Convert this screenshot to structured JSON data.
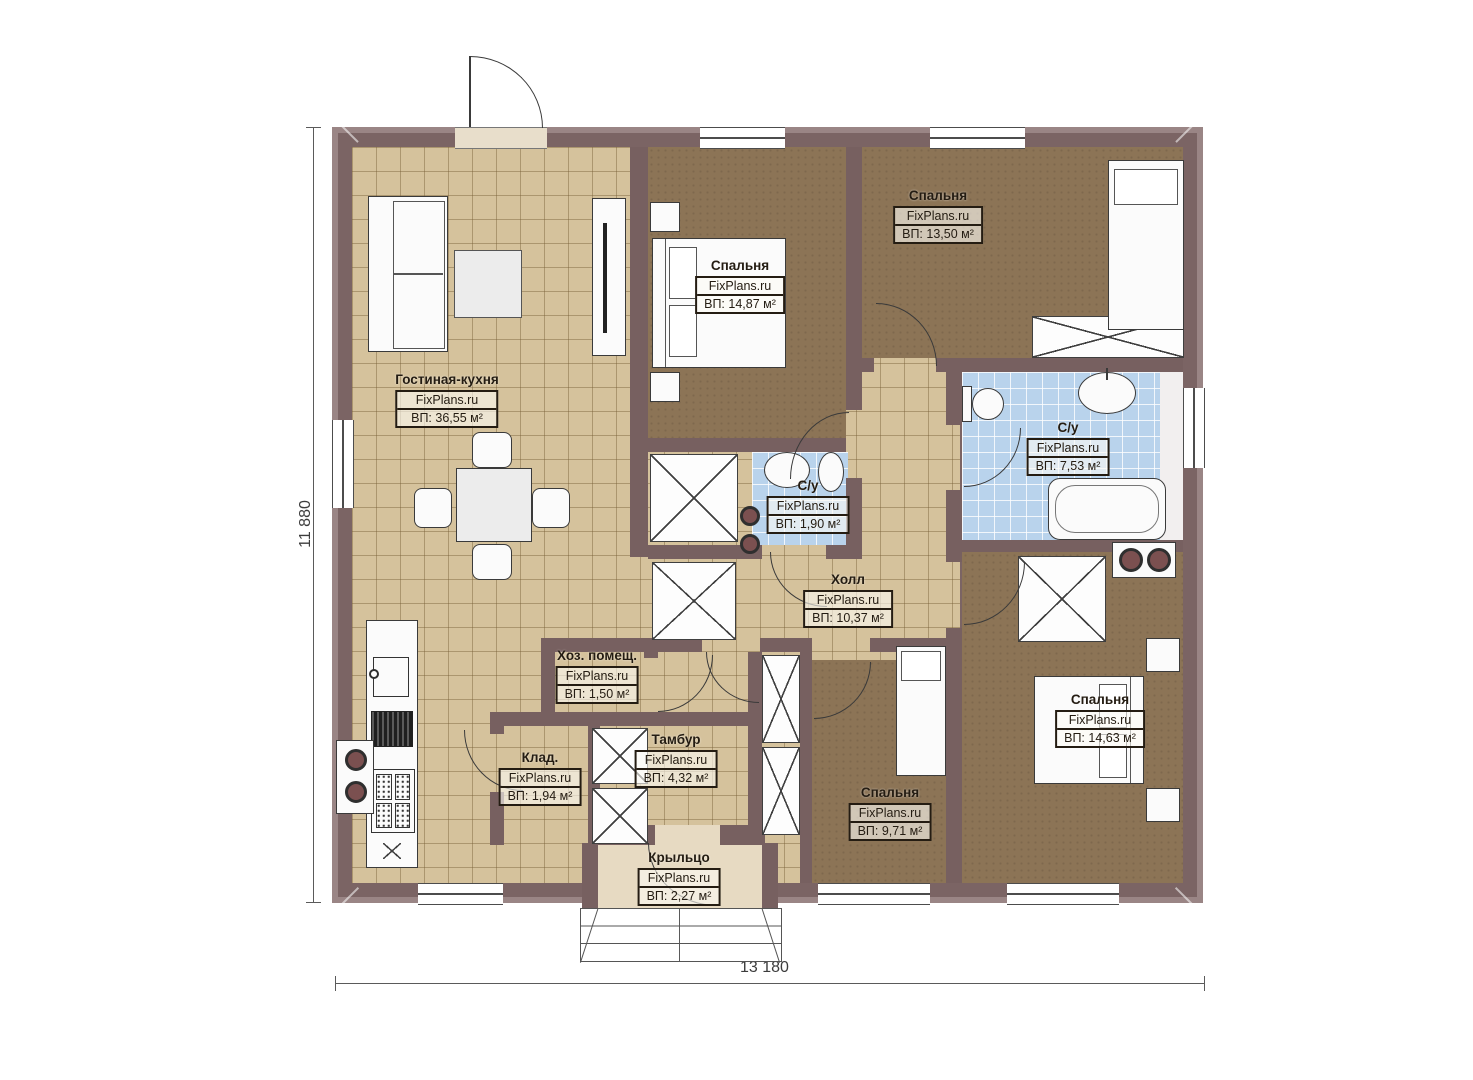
{
  "plan": {
    "title": "Одноэтажный дом — план этажа",
    "brand": "FixPlans.ru",
    "rooms": [
      {
        "name": "Гостиная-кухня",
        "brand": "FixPlans.ru",
        "area": "ВП: 36,55 м²"
      },
      {
        "name": "Спальня",
        "brand": "FixPlans.ru",
        "area": "ВП: 14,87 м²"
      },
      {
        "name": "Спальня",
        "brand": "FixPlans.ru",
        "area": "ВП: 13,50 м²"
      },
      {
        "name": "С/у",
        "brand": "FixPlans.ru",
        "area": "ВП: 7,53 м²"
      },
      {
        "name": "С/у",
        "brand": "FixPlans.ru",
        "area": "ВП: 1,90 м²"
      },
      {
        "name": "Холл",
        "brand": "FixPlans.ru",
        "area": "ВП: 10,37 м²"
      },
      {
        "name": "Хоз. помещ.",
        "brand": "FixPlans.ru",
        "area": "ВП: 1,50 м²"
      },
      {
        "name": "Тамбур",
        "brand": "FixPlans.ru",
        "area": "ВП: 4,32 м²"
      },
      {
        "name": "Клад.",
        "brand": "FixPlans.ru",
        "area": "ВП: 1,94 м²"
      },
      {
        "name": "Спальня",
        "brand": "FixPlans.ru",
        "area": "ВП: 9,71 м²"
      },
      {
        "name": "Спальня",
        "brand": "FixPlans.ru",
        "area": "ВП: 14,63 м²"
      },
      {
        "name": "Крыльцо",
        "brand": "FixPlans.ru",
        "area": "ВП: 2,27 м²"
      }
    ],
    "dimensions": {
      "overall_width": "13 180",
      "overall_height": "11 880"
    },
    "colors": {
      "wall": "#7b6464",
      "floor_tile": "#d5c29c",
      "floor_wood": "#8c7456",
      "floor_bath": "#b9d3ec",
      "floor_porch": "#e7dac2"
    }
  }
}
